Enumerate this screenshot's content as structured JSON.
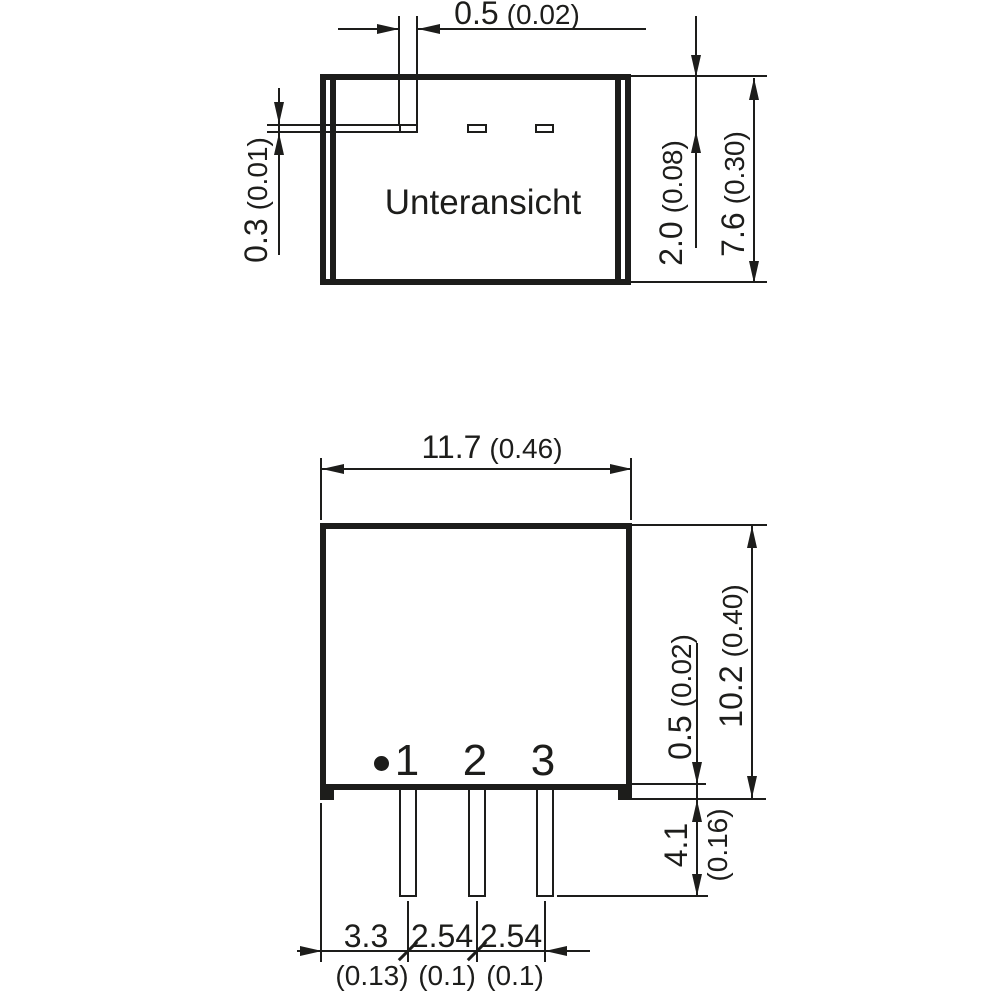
{
  "drawing": {
    "bottom_view": {
      "label": "Unteransicht",
      "dims": {
        "pad_width_mm": "0.5",
        "pad_width_in": "(0.02)",
        "pad_thickness_mm": "0.3",
        "pad_thickness_in": "(0.01)",
        "pad_inset_mm": "2.0",
        "pad_inset_in": "(0.08)",
        "body_depth_mm": "7.6",
        "body_depth_in": "(0.30)"
      }
    },
    "front_view": {
      "pins": [
        "1",
        "2",
        "3"
      ],
      "dims": {
        "body_width_mm": "11.7",
        "body_width_in": "(0.46)",
        "body_height_mm": "10.2",
        "body_height_in": "(0.40)",
        "standoff_mm": "0.5",
        "standoff_in": "(0.02)",
        "pin_length_mm": "4.1",
        "pin_length_in": "(0.16)",
        "pin1_offset_mm": "3.3",
        "pin1_offset_in": "(0.13)",
        "pitch_1_2_mm": "2.54",
        "pitch_1_2_in": "(0.1)",
        "pitch_2_3_mm": "2.54",
        "pitch_2_3_in": "(0.1)"
      }
    }
  }
}
